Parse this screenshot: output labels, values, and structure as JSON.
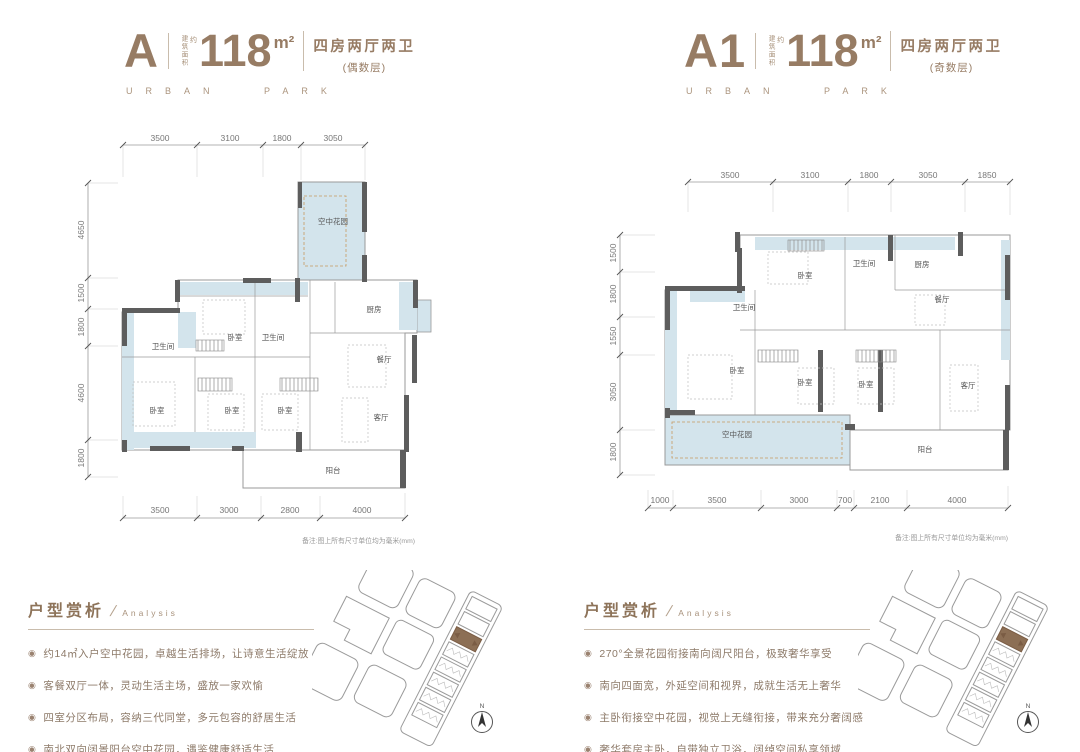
{
  "accent": "#977c64",
  "plan_blue": "#d3e4ec",
  "site": {
    "compass_label": "N"
  },
  "units": [
    {
      "name": "A",
      "area_label": "建筑面积",
      "approx": "约",
      "area": "118",
      "area_unit": "m²",
      "layout": "四房两厅两卫",
      "floor_note": "(偶数层)",
      "brand": "URBAN PARK"
    },
    {
      "name": "A1",
      "area_label": "建筑面积",
      "approx": "约",
      "area": "118",
      "area_unit": "m²",
      "layout": "四房两厅两卫",
      "floor_note": "(奇数层)",
      "brand": "URBAN PARK"
    }
  ],
  "plans": [
    {
      "dims_top": [
        "3500",
        "3100",
        "1800",
        "3050"
      ],
      "dims_left": [
        "4650",
        "1500",
        "1800",
        "4600",
        "1800"
      ],
      "dims_bottom": [
        "3500",
        "3000",
        "2800",
        "4000"
      ],
      "note": "备注:图上所有尺寸单位均为毫米(mm)",
      "rooms": [
        {
          "label": "空中花园"
        },
        {
          "label": "卧室"
        },
        {
          "label": "卫生间"
        },
        {
          "label": "卫生间"
        },
        {
          "label": "厨房"
        },
        {
          "label": "餐厅"
        },
        {
          "label": "卧室"
        },
        {
          "label": "卧室"
        },
        {
          "label": "卧室"
        },
        {
          "label": "客厅"
        },
        {
          "label": "阳台"
        }
      ]
    },
    {
      "dims_top": [
        "3500",
        "3100",
        "1800",
        "3050",
        "1850"
      ],
      "dims_left": [
        "1500",
        "1800",
        "1550",
        "3050",
        "1800"
      ],
      "dims_bottom": [
        "1000",
        "3500",
        "3000",
        "700",
        "2100",
        "4000"
      ],
      "note": "备注:图上所有尺寸单位均为毫米(mm)",
      "rooms": [
        {
          "label": "卧室"
        },
        {
          "label": "卫生间"
        },
        {
          "label": "厨房"
        },
        {
          "label": "餐厅"
        },
        {
          "label": "卫生间"
        },
        {
          "label": "卧室"
        },
        {
          "label": "卧室"
        },
        {
          "label": "卧室"
        },
        {
          "label": "客厅"
        },
        {
          "label": "空中花园"
        },
        {
          "label": "阳台"
        }
      ]
    }
  ],
  "analysis": [
    {
      "title": "户型赏析",
      "subtitle": "Analysis",
      "bullets": [
        "约14㎡入户空中花园，卓越生活排场，让诗意生活绽放",
        "客餐双厅一体，灵动生活主场，盛放一家欢愉",
        "四室分区布局，容纳三代同堂，多元包容的舒居生活",
        "南北双向阔景阳台空中花园，遇鉴健康舒适生活"
      ]
    },
    {
      "title": "户型赏析",
      "subtitle": "Analysis",
      "bullets": [
        "270°全景花园衔接南向阔尺阳台，极致奢华享受",
        "南向四面宽，外延空间和视界，成就生活无上奢华",
        "主卧衔接空中花园，视觉上无缝衔接，带来充分奢阔感",
        "奢华套房主卧，自带独立卫浴，阔绰空间私享领域"
      ]
    }
  ]
}
